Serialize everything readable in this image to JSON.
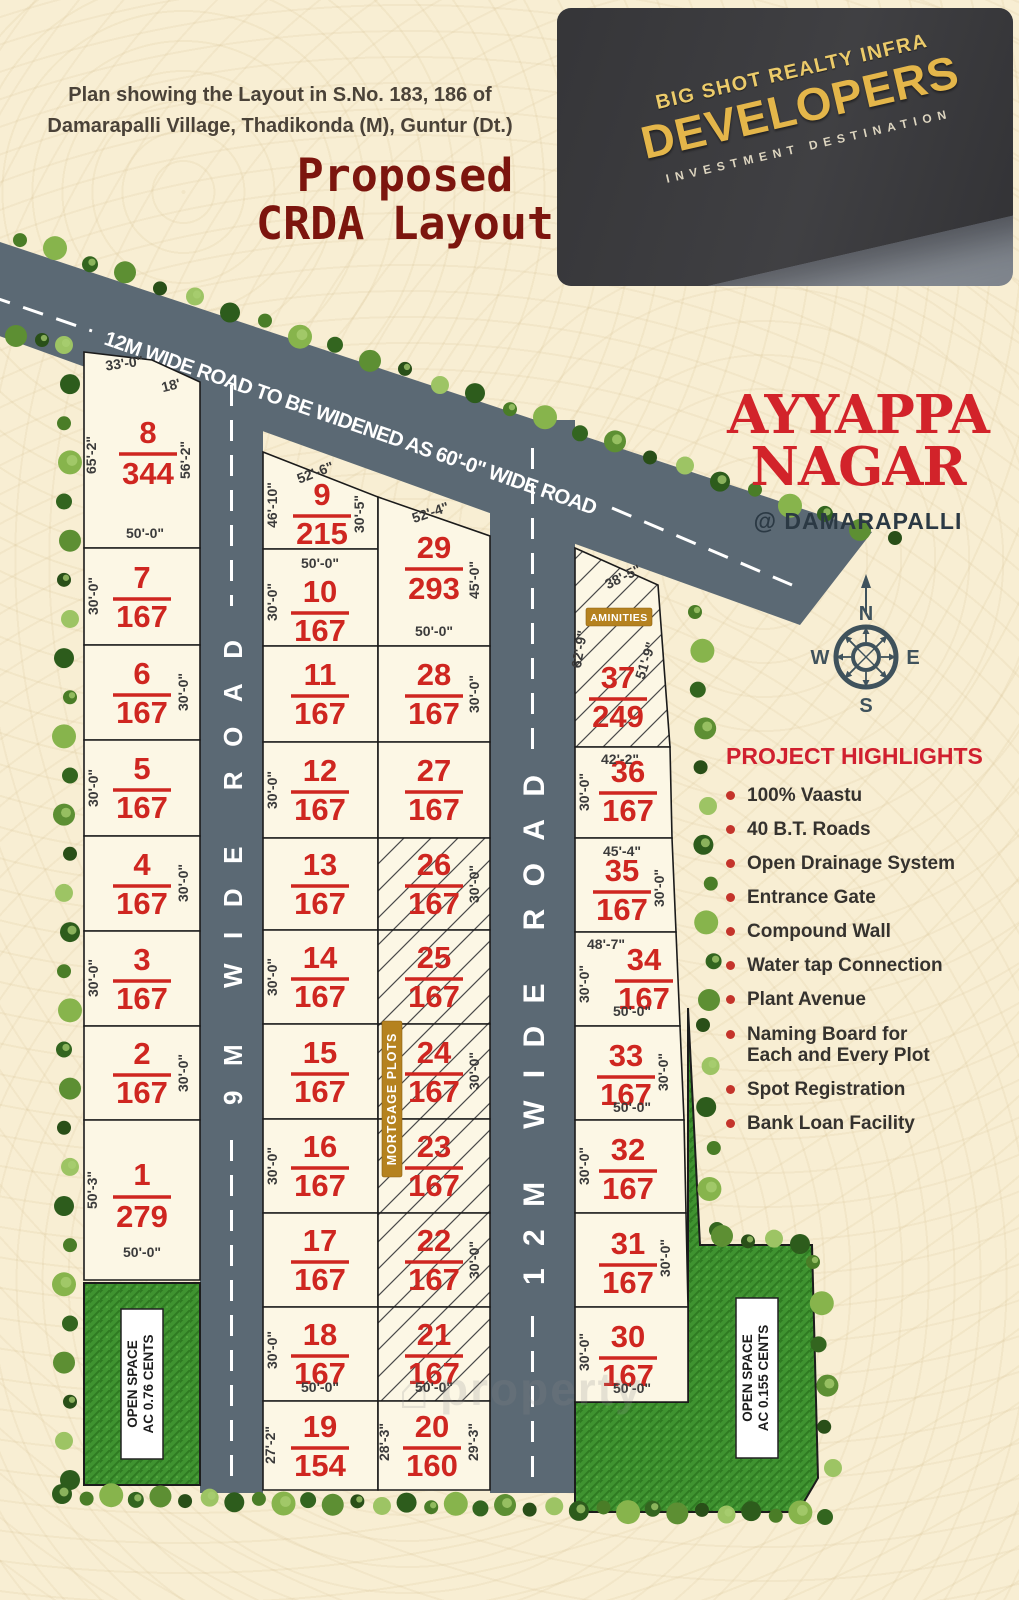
{
  "header": {
    "plan_line1": "Plan showing the Layout in S.No. 183, 186 of",
    "plan_line2": "Damarapalli Village, Thadikonda (M), Guntur (Dt.)",
    "title_line1": "Proposed",
    "title_line2": "CRDA Layout"
  },
  "logo": {
    "brand_line1": "BIG SHOT REALTY INFRA",
    "brand_line2": "DEVELOPERS",
    "tagline": "INVESTMENT DESTINATION"
  },
  "project": {
    "name_line1": "AYYAPPA",
    "name_line2": "NAGAR",
    "location": "@ DAMARAPALLI"
  },
  "compass": {
    "north": "N",
    "east": "E",
    "west": "W",
    "south": "S"
  },
  "highlights": {
    "title": "PROJECT HIGHLIGHTS",
    "items": [
      "100% Vaastu",
      "40 B.T. Roads",
      "Open Drainage System",
      "Entrance Gate",
      "Compound Wall",
      "Water tap Connection",
      "Plant Avenue",
      "Naming Board for\nEach and Every Plot",
      "Spot Registration",
      "Bank Loan Facility"
    ]
  },
  "roads": {
    "top_road": "12M WIDE ROAD TO BE WIDENED AS 60'-0\" WIDE ROAD",
    "road_9m": "9M WIDE ROAD",
    "road_12m": "12M WIDE ROAD"
  },
  "labels": {
    "mortgage": "MORTGAGE PLOTS",
    "amenities": "AMINITIES",
    "open_space_left_line1": "OPEN SPACE",
    "open_space_left_line2": "AC 0.76 CENTS",
    "open_space_right_line1": "OPEN SPACE",
    "open_space_right_line2": "AC 0.155 CENTS",
    "watermark": "property"
  },
  "colors": {
    "road": "#5b6974",
    "plot_fill": "#fcf7e5",
    "plot_red": "#cf2620",
    "badge_gold": "#b5821f",
    "grass": "#3f9330",
    "accent_red": "#d2232a"
  },
  "plots": [
    {
      "no": "8",
      "area": "344",
      "hatched": false,
      "dims": [
        "33'-0\"",
        "18'",
        "65'-2\"",
        "56'-2\"",
        "50'-0\""
      ]
    },
    {
      "no": "7",
      "area": "167",
      "hatched": false,
      "dims": [
        "30'-0\""
      ]
    },
    {
      "no": "6",
      "area": "167",
      "hatched": false,
      "dims": [
        "30'-0\""
      ]
    },
    {
      "no": "5",
      "area": "167",
      "hatched": false,
      "dims": [
        "30'-0\""
      ]
    },
    {
      "no": "4",
      "area": "167",
      "hatched": false,
      "dims": [
        "30'-0\""
      ]
    },
    {
      "no": "3",
      "area": "167",
      "hatched": false,
      "dims": [
        "30'-0\""
      ]
    },
    {
      "no": "2",
      "area": "167",
      "hatched": false,
      "dims": [
        "30'-0\""
      ]
    },
    {
      "no": "1",
      "area": "279",
      "hatched": false,
      "dims": [
        "50'-3\"",
        "50'-0\""
      ]
    },
    {
      "no": "9",
      "area": "215",
      "hatched": false,
      "dims": [
        "52'-6\"",
        "46'-10\"",
        "30'-5\""
      ]
    },
    {
      "no": "10",
      "area": "167",
      "hatched": false,
      "dims": [
        "50'-0\"",
        "30'-0\""
      ]
    },
    {
      "no": "11",
      "area": "167",
      "hatched": false,
      "dims": []
    },
    {
      "no": "12",
      "area": "167",
      "hatched": false,
      "dims": [
        "30'-0\""
      ]
    },
    {
      "no": "13",
      "area": "167",
      "hatched": false,
      "dims": []
    },
    {
      "no": "14",
      "area": "167",
      "hatched": false,
      "dims": [
        "30'-0\""
      ]
    },
    {
      "no": "15",
      "area": "167",
      "hatched": false,
      "dims": []
    },
    {
      "no": "16",
      "area": "167",
      "hatched": false,
      "dims": [
        "30'-0\""
      ]
    },
    {
      "no": "17",
      "area": "167",
      "hatched": false,
      "dims": []
    },
    {
      "no": "18",
      "area": "167",
      "hatched": false,
      "dims": [
        "30'-0\"",
        "50'-0\""
      ]
    },
    {
      "no": "19",
      "area": "154",
      "hatched": false,
      "dims": [
        "27'-2\""
      ]
    },
    {
      "no": "29",
      "area": "293",
      "hatched": false,
      "dims": [
        "52'-4\"",
        "45'-0\"",
        "50'-0\""
      ]
    },
    {
      "no": "28",
      "area": "167",
      "hatched": false,
      "dims": [
        "30'-0\""
      ]
    },
    {
      "no": "27",
      "area": "167",
      "hatched": false,
      "dims": []
    },
    {
      "no": "26",
      "area": "167",
      "hatched": true,
      "dims": [
        "30'-0\""
      ]
    },
    {
      "no": "25",
      "area": "167",
      "hatched": true,
      "dims": []
    },
    {
      "no": "24",
      "area": "167",
      "hatched": true,
      "dims": [
        "30'-0\""
      ]
    },
    {
      "no": "23",
      "area": "167",
      "hatched": true,
      "dims": []
    },
    {
      "no": "22",
      "area": "167",
      "hatched": true,
      "dims": [
        "30'-0\""
      ]
    },
    {
      "no": "21",
      "area": "167",
      "hatched": true,
      "dims": [
        "50'-0\""
      ]
    },
    {
      "no": "20",
      "area": "160",
      "hatched": false,
      "dims": [
        "28'-3\"",
        "29'-3\""
      ]
    },
    {
      "no": "37",
      "area": "249",
      "hatched": true,
      "dims": [
        "38'-5\"",
        "62'-9\"",
        "51'-9\""
      ]
    },
    {
      "no": "36",
      "area": "167",
      "hatched": false,
      "dims": [
        "42'-2\"",
        "30'-0\""
      ]
    },
    {
      "no": "35",
      "area": "167",
      "hatched": false,
      "dims": [
        "45'-4\"",
        "30'-0\""
      ]
    },
    {
      "no": "34",
      "area": "167",
      "hatched": false,
      "dims": [
        "48'-7\"",
        "30'-0\"",
        "50'-0\""
      ]
    },
    {
      "no": "33",
      "area": "167",
      "hatched": false,
      "dims": [
        "30'-0\"",
        "50'-0\""
      ]
    },
    {
      "no": "32",
      "area": "167",
      "hatched": false,
      "dims": [
        "30'-0\""
      ]
    },
    {
      "no": "31",
      "area": "167",
      "hatched": false,
      "dims": [
        "30'-0\""
      ]
    },
    {
      "no": "30",
      "area": "167",
      "hatched": false,
      "dims": [
        "30'-0\"",
        "50'-0\""
      ]
    }
  ]
}
